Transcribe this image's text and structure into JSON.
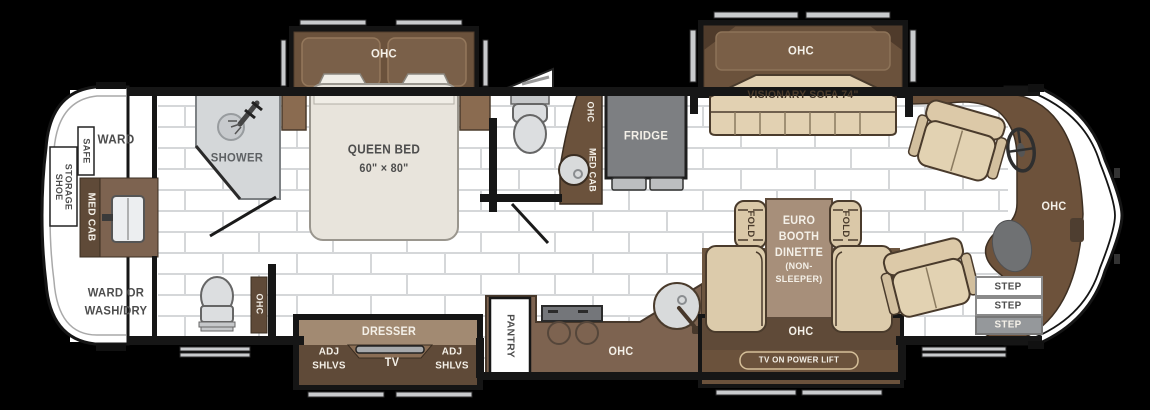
{
  "diagram_type": "rv-motorhome-floor-plan",
  "colors": {
    "wall": "#161616",
    "cabinet_dark": "#5f4a38",
    "cabinet_medium": "#6b523c",
    "counter_brown": "#7d6350",
    "wood_light": "#a28a72",
    "upholstery_tan": "#dccbab",
    "mattress_cream": "#e8e4dc",
    "appliance_gray": "#7d7f82",
    "fixture_gray": "#d6d8da",
    "tile_line": "#d5d7d9",
    "floor": "#ffffff"
  },
  "fixtures": [
    "shower-head",
    "shower-drain",
    "toilet",
    "sink",
    "cooktop",
    "steering-wheel",
    "captain-chair",
    "sofa",
    "booth-seat",
    "fold-chair",
    "entry-steps",
    "slide-out-rails"
  ],
  "labels": {
    "ward": "WARD",
    "safe": "SAFE",
    "shoe_storage_1": "SHOE",
    "shoe_storage_2": "STORAGE",
    "med_cab_rear": "MED CAB",
    "ward_wash_1": "WARD OR",
    "ward_wash_2": "WASH/DRY",
    "shower": "SHOWER",
    "ohc_bed": "OHC",
    "queen_bed_1": "QUEEN BED",
    "queen_bed_2": "60\" × 80\"",
    "ohc_rear": "OHC",
    "ohc_midbath": "OHC",
    "med_cab_midbath": "MED CAB",
    "fridge": "FRIDGE",
    "ohc_sofa": "OHC",
    "sofa": "VISIONARY SOFA 74\"",
    "fold_left": "FOLD",
    "fold_right": "FOLD",
    "dinette_1": "EURO",
    "dinette_2": "BOOTH",
    "dinette_3": "DINETTE",
    "dinette_4": "(NON-",
    "dinette_5": "SLEEPER)",
    "ohc_dinette": "OHC",
    "tv_power_lift": "TV ON POWER LIFT",
    "ohc_kitchen": "OHC",
    "pantry": "PANTRY",
    "dresser": "DRESSER",
    "tv": "TV",
    "adj_shlvs_left_1": "ADJ",
    "adj_shlvs_left_2": "SHLVS",
    "adj_shlvs_right_1": "ADJ",
    "adj_shlvs_right_2": "SHLVS",
    "ohc_dash": "OHC",
    "step_1": "STEP",
    "step_2": "STEP",
    "step_3": "STEP"
  }
}
